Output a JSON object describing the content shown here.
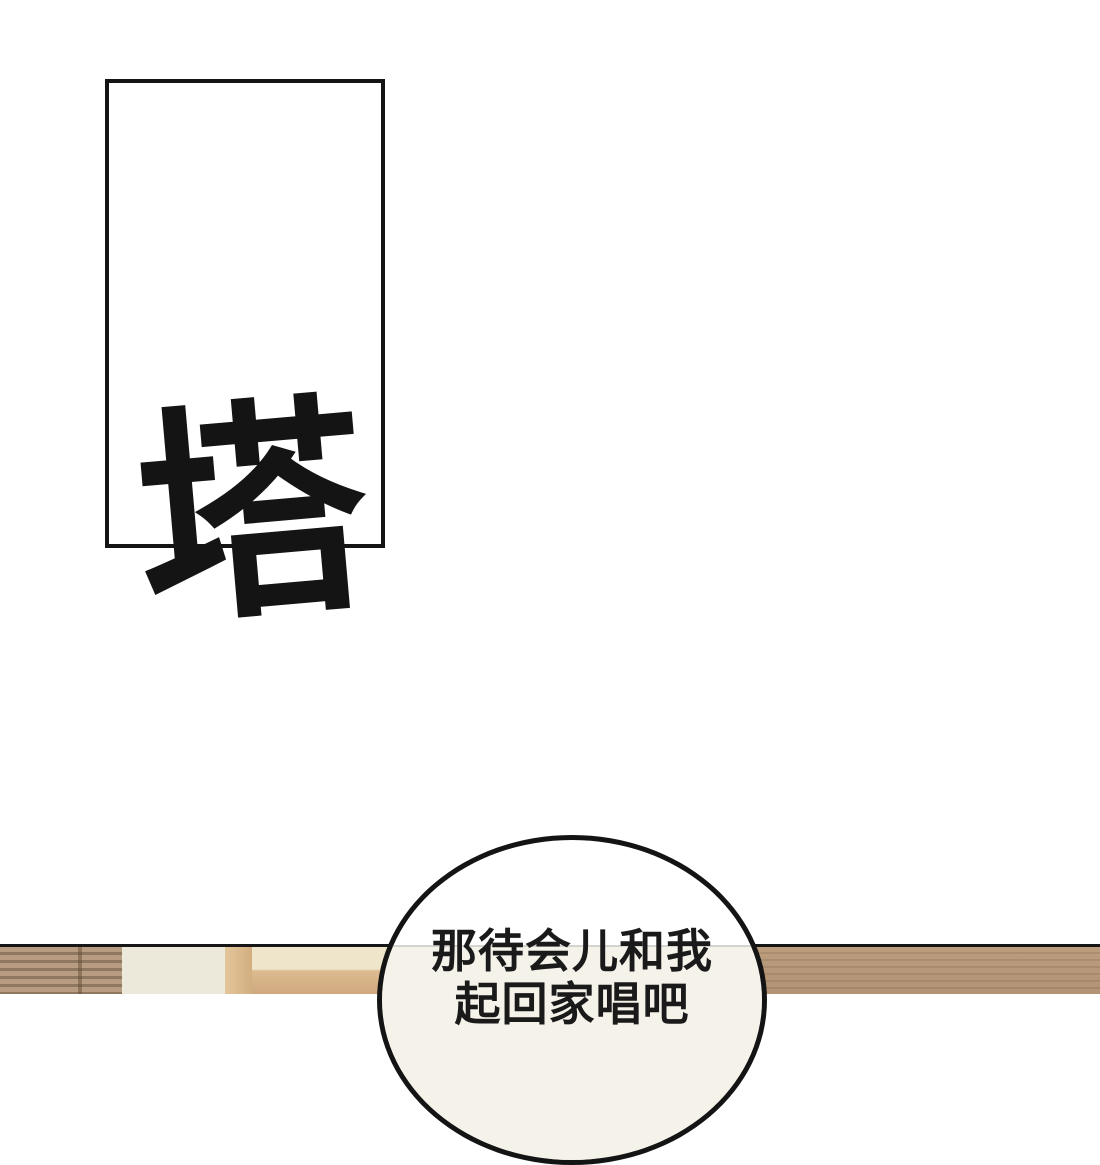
{
  "page": {
    "background_color": "#ffffff",
    "ink_color": "#141414"
  },
  "panel": {
    "type": "empty-rectangular-comic-panel"
  },
  "sfx": {
    "text": "塔"
  },
  "speech_bubble": {
    "lines": [
      "那待会儿和我",
      "起回家唱吧"
    ],
    "fill_color": "#ffffff",
    "border_color": "#141414"
  },
  "scene": {
    "divider_line_color": "#161616",
    "colors": {
      "blinds_base": "#b89c81",
      "blinds_slats": "#8f775f",
      "wall_cream": "#ece8da",
      "wood_post": "#d8b88c",
      "shelf_top": "#efe5ca",
      "shelf_band": "#d9b88e",
      "right_wall_tan": "#b69778"
    }
  }
}
